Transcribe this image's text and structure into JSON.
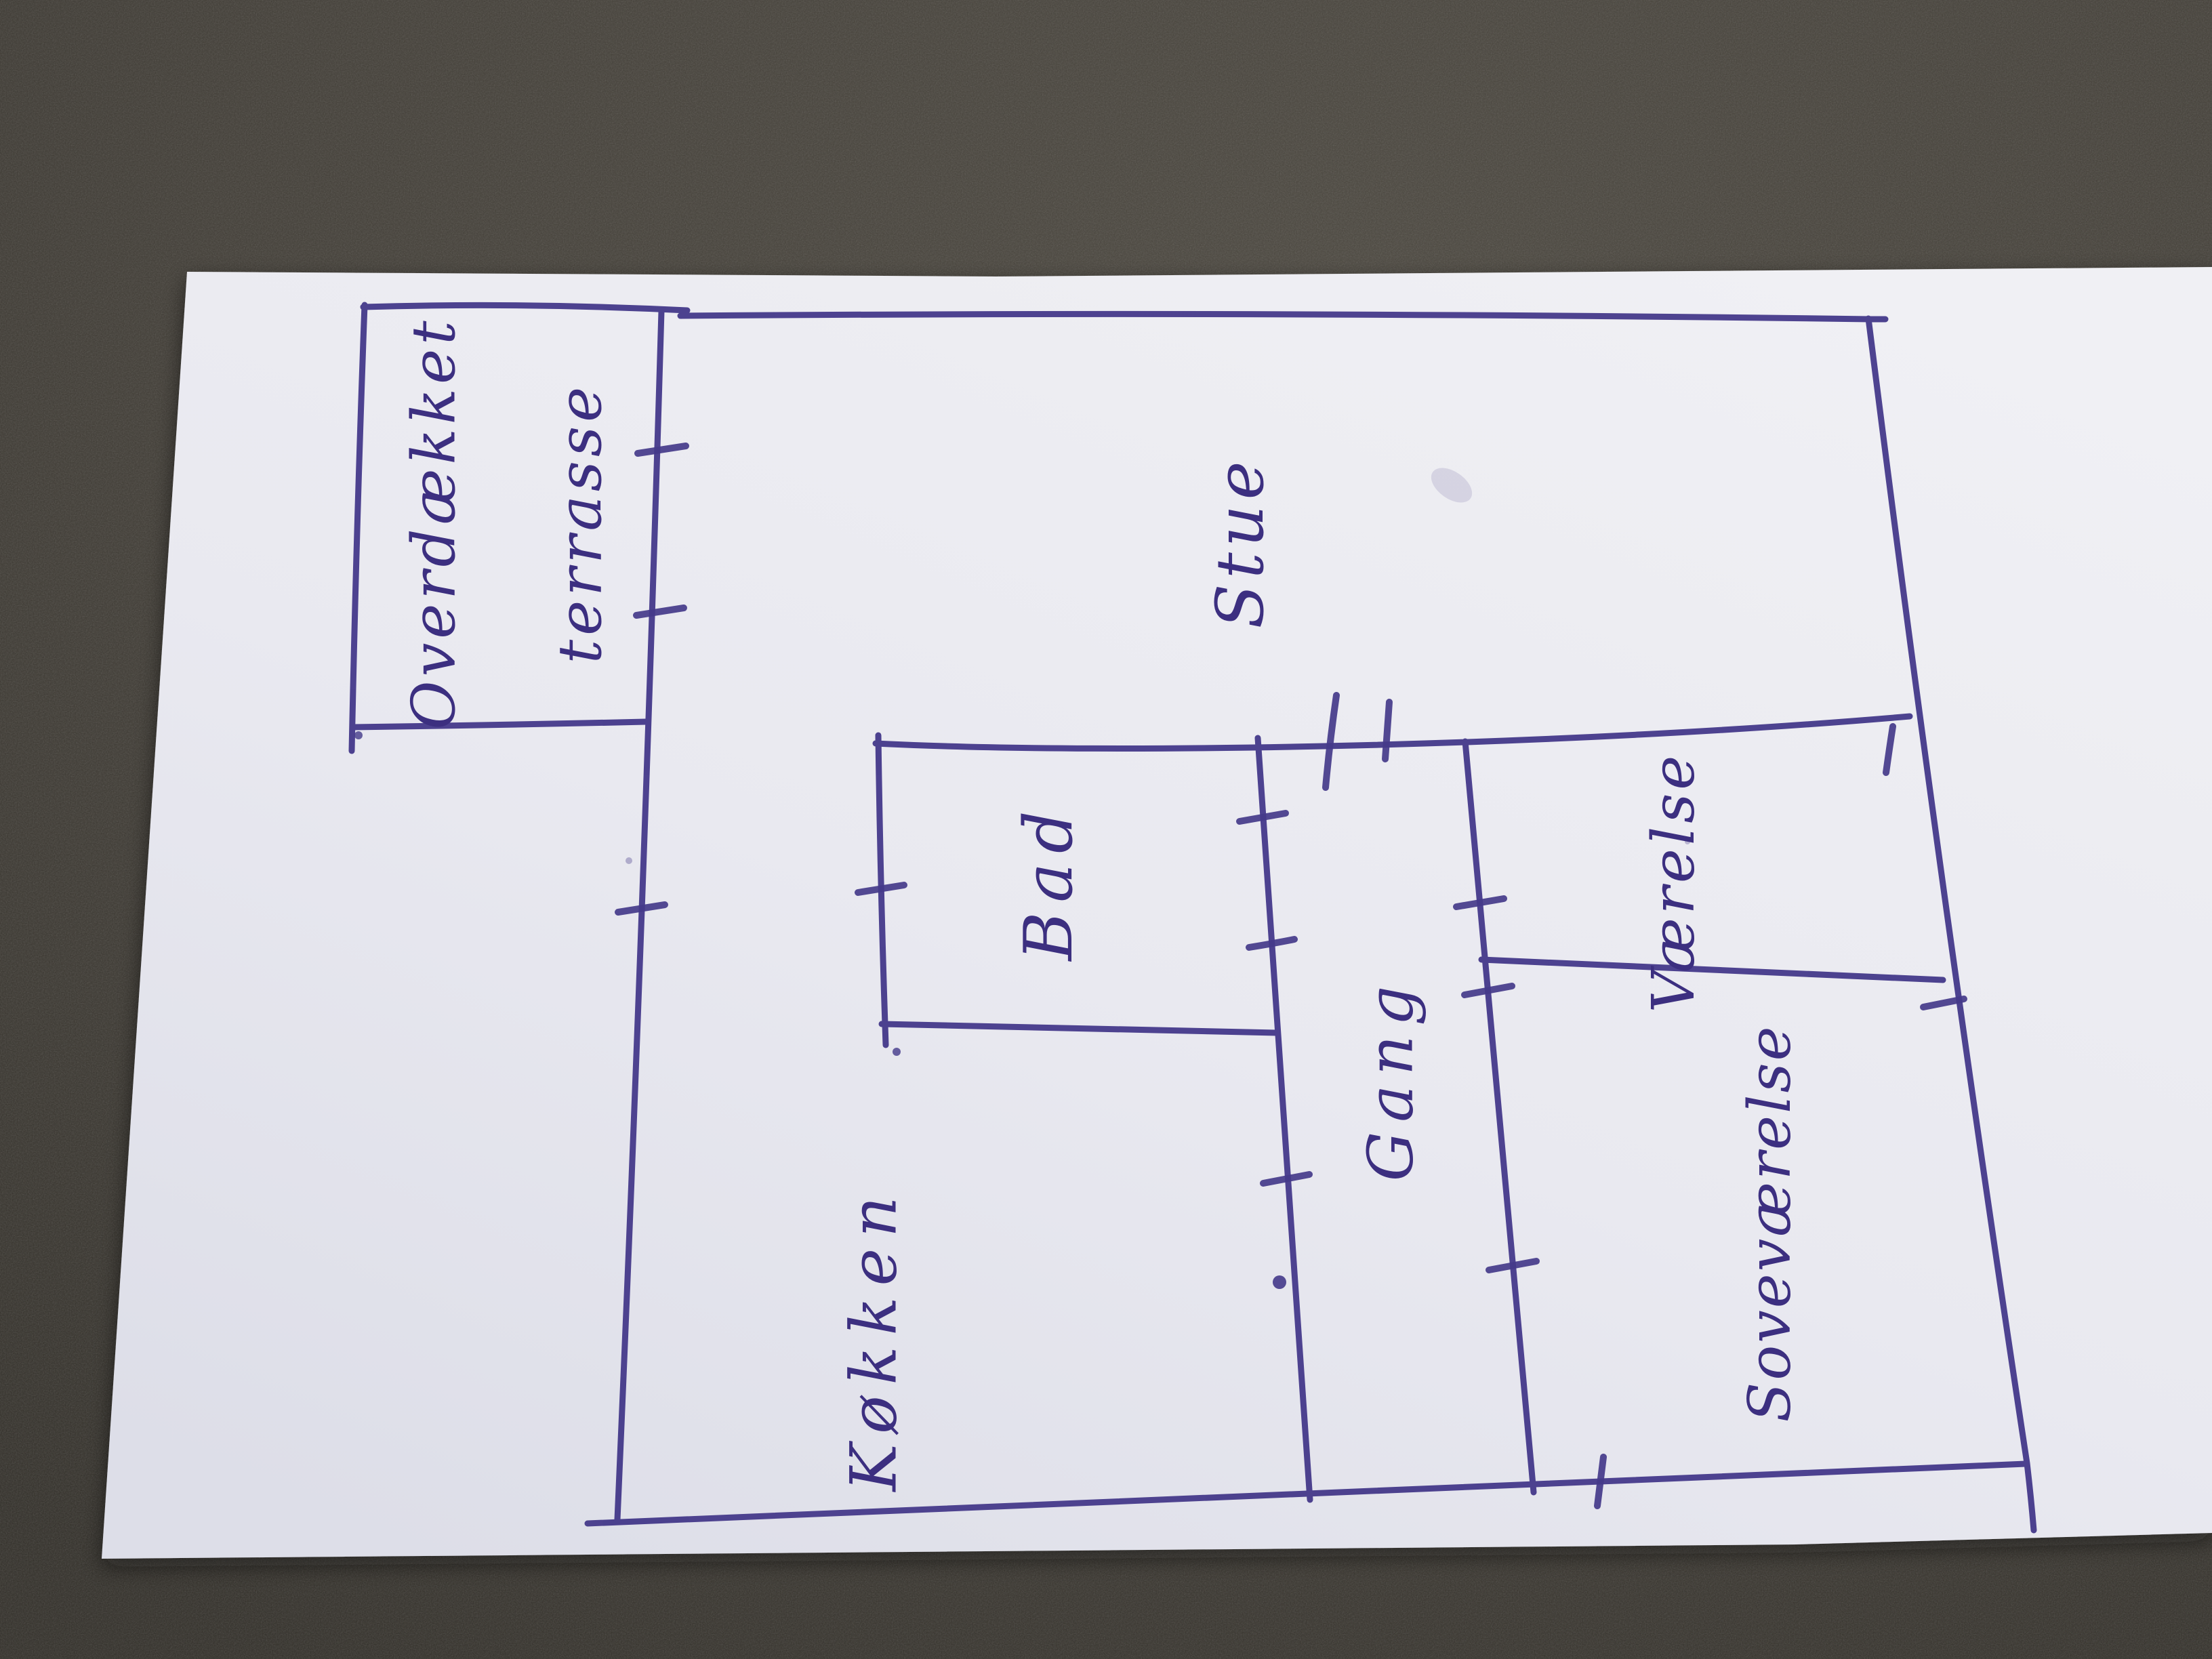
{
  "floor_plan": {
    "labels": {
      "terrace_line1": "Overdækket",
      "terrace_line2": "terrasse",
      "living_room": "Stue",
      "bathroom": "Bad",
      "kitchen": "Køkken",
      "hallway": "Gang",
      "room": "Værelse",
      "bedroom": "Soveværelse"
    },
    "colors": {
      "ink": "#44398a",
      "paper": "#e9e9f0",
      "fabric": "#45413a"
    }
  }
}
